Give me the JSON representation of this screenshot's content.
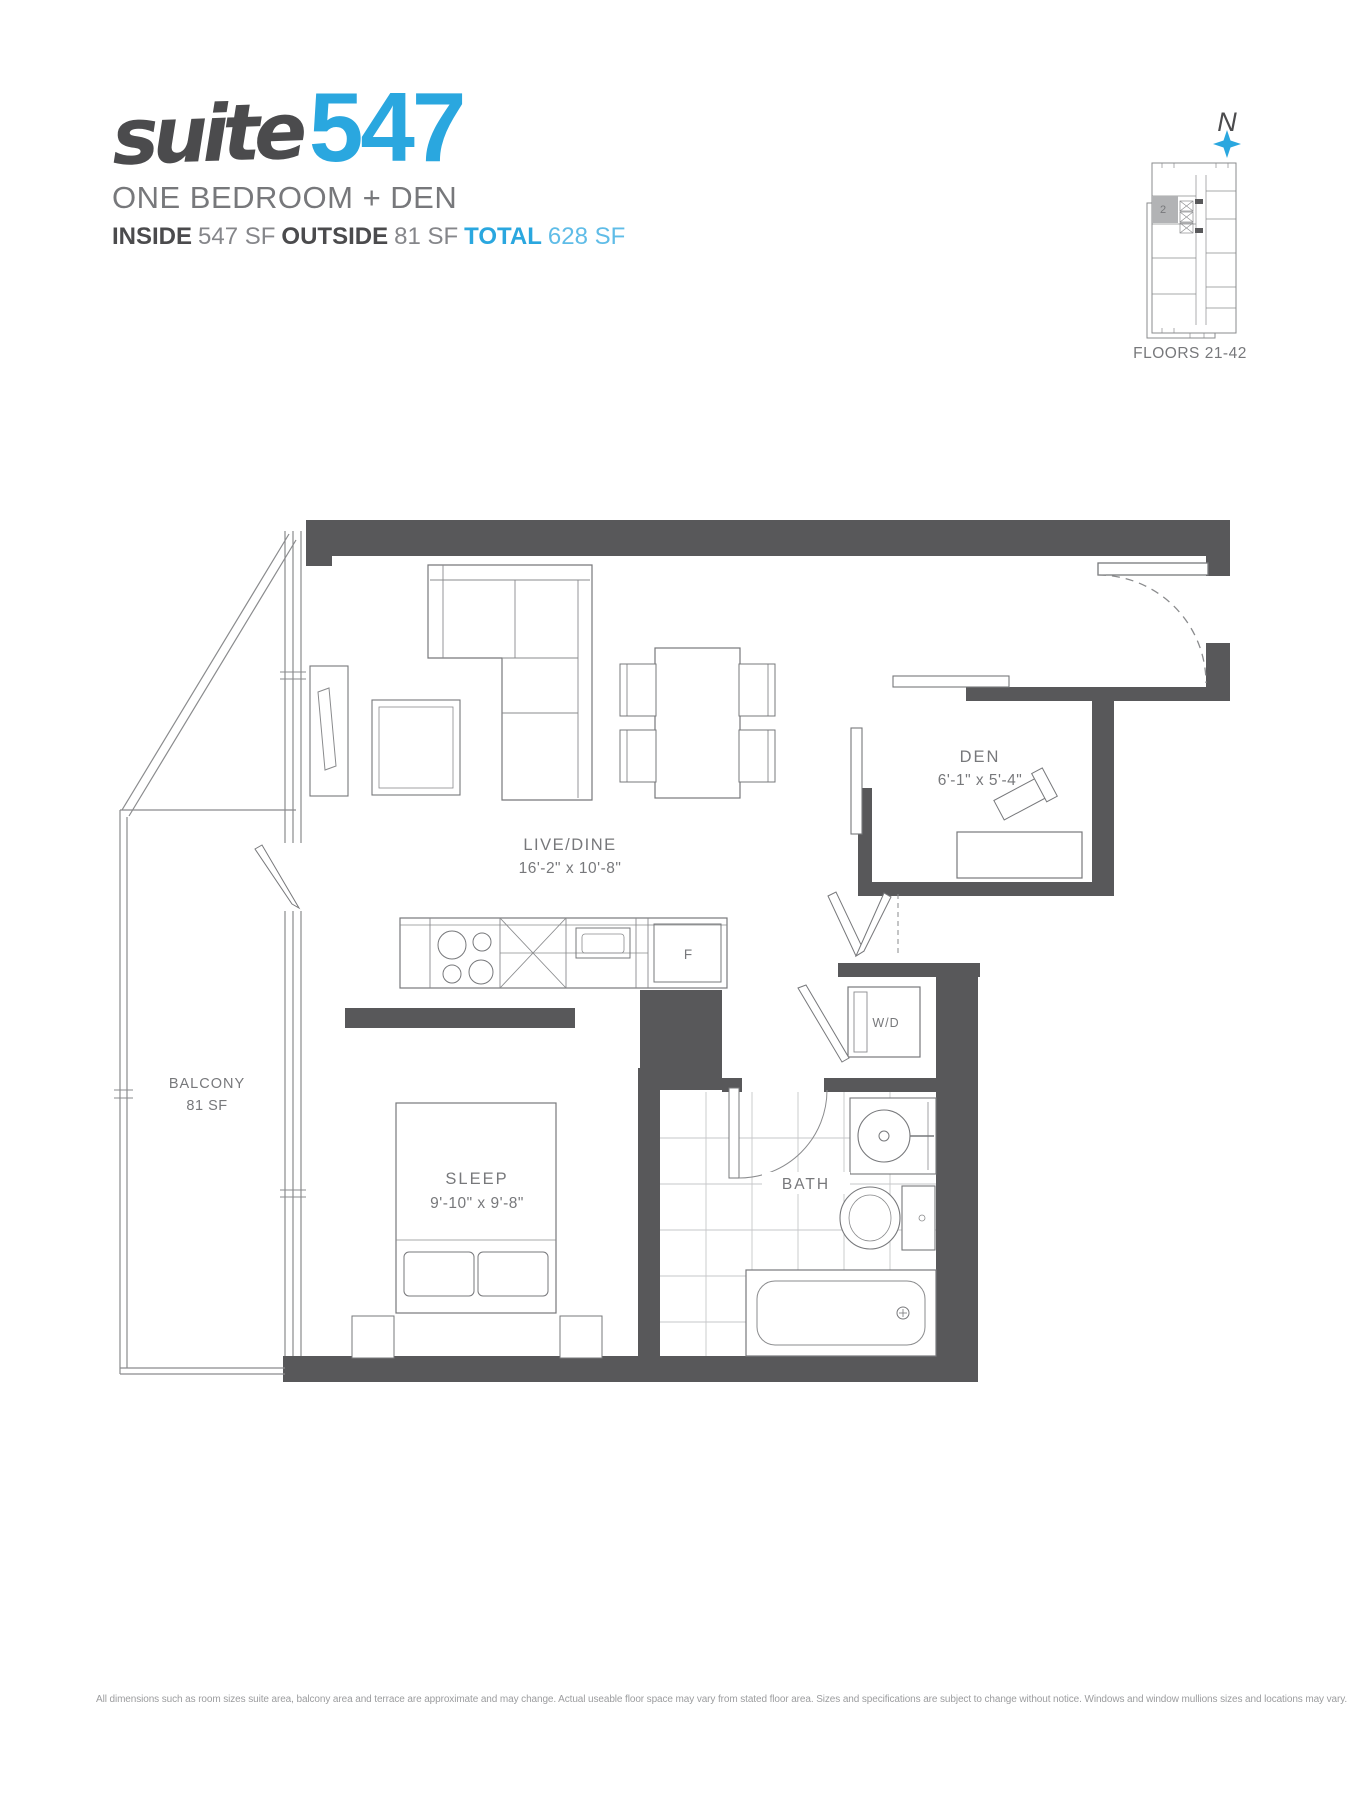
{
  "header": {
    "brand_script": "suite",
    "suite_number": "547",
    "subtitle": "ONE BEDROOM + DEN",
    "stats": {
      "inside_label": "INSIDE",
      "inside_value": "547 SF",
      "outside_label": "OUTSIDE",
      "outside_value": "81 SF",
      "total_label": "TOTAL",
      "total_value": "628 SF"
    }
  },
  "keyplan": {
    "north": "N",
    "highlight_unit": "2",
    "floors": "FLOORS 21-42"
  },
  "rooms": {
    "livedine": {
      "name": "LIVE/DINE",
      "dims": "16'-2\" x 10'-8\""
    },
    "den": {
      "name": "DEN",
      "dims": "6'-1\" x 5'-4\""
    },
    "sleep": {
      "name": "SLEEP",
      "dims": "9'-10\" x 9'-8\""
    },
    "bath": {
      "name": "BATH"
    },
    "balcony": {
      "name": "BALCONY",
      "area": "81 SF"
    },
    "wd": "W/D",
    "fridge": "F"
  },
  "icons": {
    "north_marker": "north-plus-icon"
  },
  "footer": {
    "disclaimer": "All dimensions such as room sizes suite area, balcony area and terrace are approximate and may change. Actual useable floor space may vary from stated floor area. Sizes and specifications are subject to change without notice. Windows and window mullions sizes and locations may vary. E. & O. E."
  },
  "colors": {
    "accent_blue": "#2AA7DF",
    "wall_gray": "#58585A",
    "ink": "#4B4B4D",
    "muted_text": "#77787B"
  }
}
